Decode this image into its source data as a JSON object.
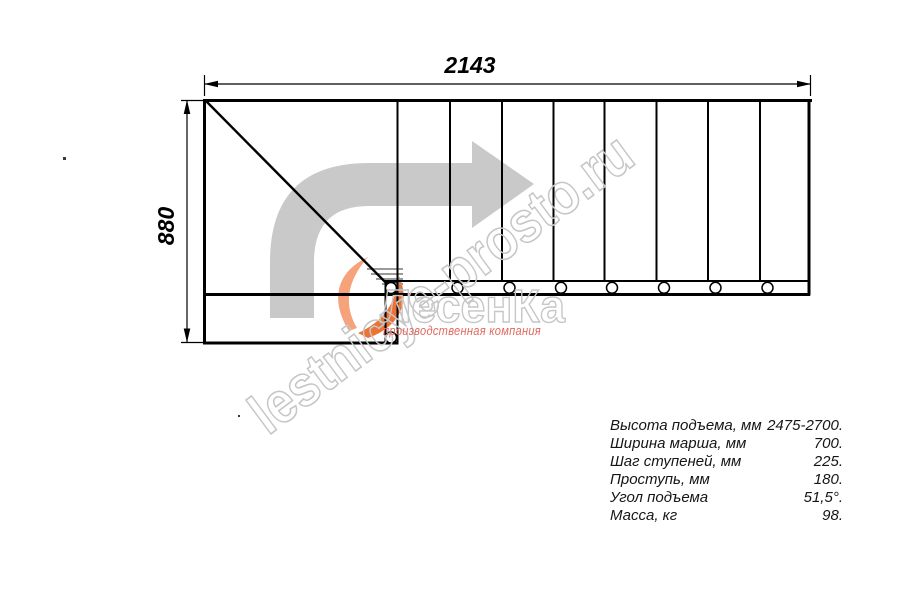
{
  "drawing": {
    "top_dimension": "2143",
    "left_dimension": "880"
  },
  "specs": {
    "rows": [
      {
        "label": "Высота подъема, мм",
        "value": "2475-2700."
      },
      {
        "label": "Ширина марша, мм",
        "value": "700."
      },
      {
        "label": "Шаг ступеней, мм",
        "value": "225."
      },
      {
        "label": "Проступь, мм",
        "value": "180."
      },
      {
        "label": "Угол подъема",
        "value": "51,5°."
      },
      {
        "label": "Масса, кг",
        "value": "98."
      }
    ]
  },
  "watermark": {
    "site_text": "lestnicye-prosto.ru",
    "logo_text": "ЛесенКа",
    "logo_subtitle": "производственная компания"
  },
  "colors": {
    "arrow_gray": "#c9c9c9",
    "watermark_outline": "#c6c6c6",
    "logo_subtitle_red": "#e16a60",
    "flame_orange": "#ed7335",
    "flame_light": "#f6a27b",
    "line_black": "#000000"
  }
}
